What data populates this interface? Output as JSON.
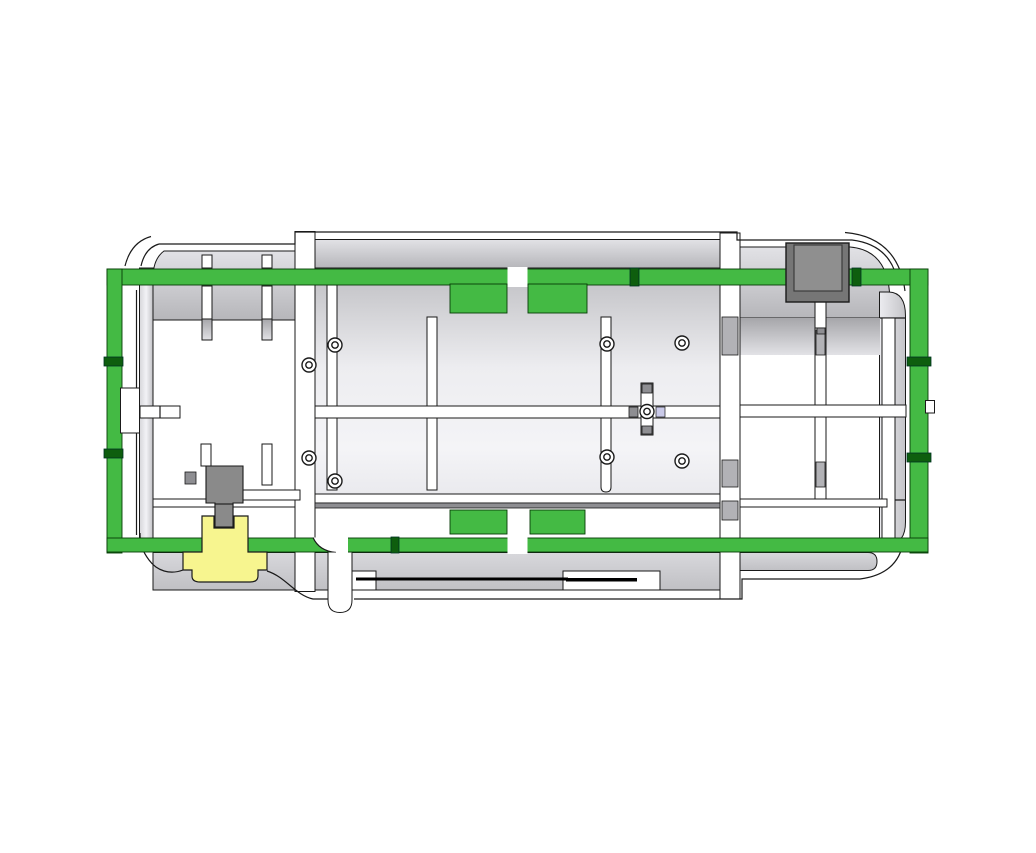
{
  "scene": {
    "kind": "cad-cross-section-view",
    "description": "Sectioned enclosure assembly with perimeter gasket and highlighted components",
    "background": "#ffffff"
  },
  "colors": {
    "white": "#ffffff",
    "outline": "#1a1a1a",
    "gasket": "#44ba44",
    "gasket_dark": "#0e5e0e",
    "gasket_edge": "#063c06",
    "wall_light": "#e2e2e6",
    "wall_dark": "#b6b6ba",
    "panel_light": "#f4f4f7",
    "panel_dark": "#c6c6ca",
    "slab_light": "#d8d8dc",
    "slab_dark": "#c0c0c4",
    "tab_gray": "#b2b2b6",
    "cap_gray": "#8e8e92",
    "connector_gray": "#767676",
    "connector_inner": "#8f8f8f",
    "plug_gray": "#8a8a8a",
    "plug_yellow": "#f7f58f",
    "accent_lavender": "#c9c9e8",
    "slot_black": "#000000"
  },
  "parts": [
    {
      "name": "housing",
      "label": "enclosure-housing",
      "color_key": "wall_light"
    },
    {
      "name": "gasket-seal",
      "label": "perimeter-gasket-seal",
      "color_key": "gasket"
    },
    {
      "name": "corner-connector",
      "label": "corner-mount-connector",
      "color_key": "connector_gray"
    },
    {
      "name": "valve-stem",
      "label": "valve-stem",
      "color_key": "plug_gray"
    },
    {
      "name": "drain-plug",
      "label": "highlighted-drain-plug",
      "color_key": "plug_yellow"
    },
    {
      "name": "drain-tube",
      "label": "drain-tube",
      "color_key": "white"
    },
    {
      "name": "screw-boss",
      "label": "screw-boss",
      "color_key": "white"
    }
  ]
}
